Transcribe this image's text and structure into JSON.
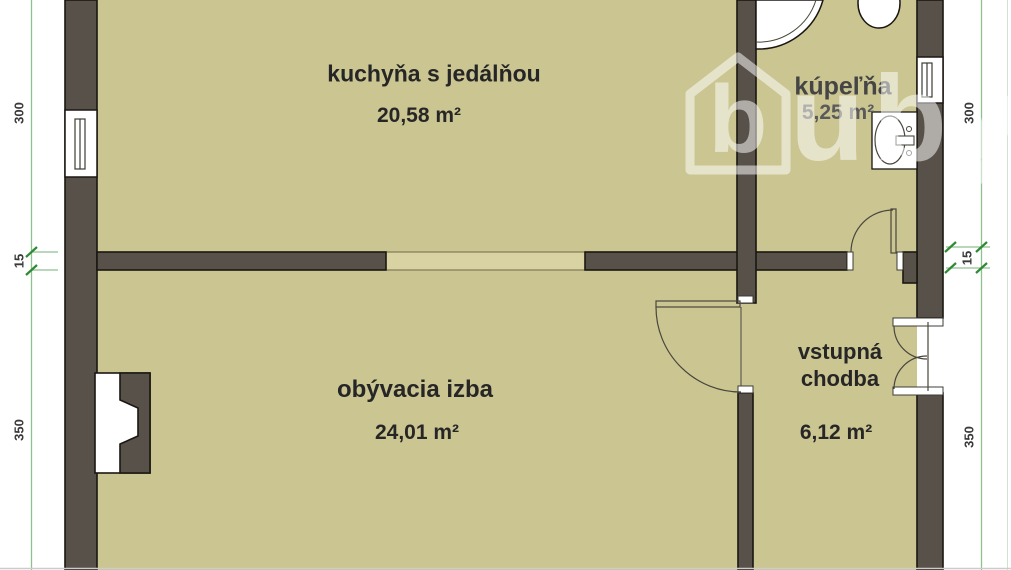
{
  "rooms": {
    "kitchen": {
      "name": "kuchyňa s jedálňou",
      "area": "20,58 m²"
    },
    "bathroom": {
      "name": "kúpeľňa",
      "area": "5,25 m²"
    },
    "living_room": {
      "name": "obývacia izba",
      "area": "24,01 m²"
    },
    "hall": {
      "name": "vstupná chodba",
      "area": "6,12 m²"
    }
  },
  "dimensions": {
    "left": {
      "top": "300",
      "middle": "15",
      "bottom": "350"
    },
    "right": {
      "top": "300",
      "middle": "15",
      "bottom": "350"
    }
  },
  "watermark": {
    "logo_letter": "b",
    "text": "uby"
  },
  "colors": {
    "floor": "#cbc592",
    "opening": "#d9d3a4",
    "wall": "#58514a",
    "outline": "#1a1712",
    "dimension_line": "#8fc08f",
    "dimension_tick": "#2e8a33",
    "watermark": "#ffffff"
  }
}
